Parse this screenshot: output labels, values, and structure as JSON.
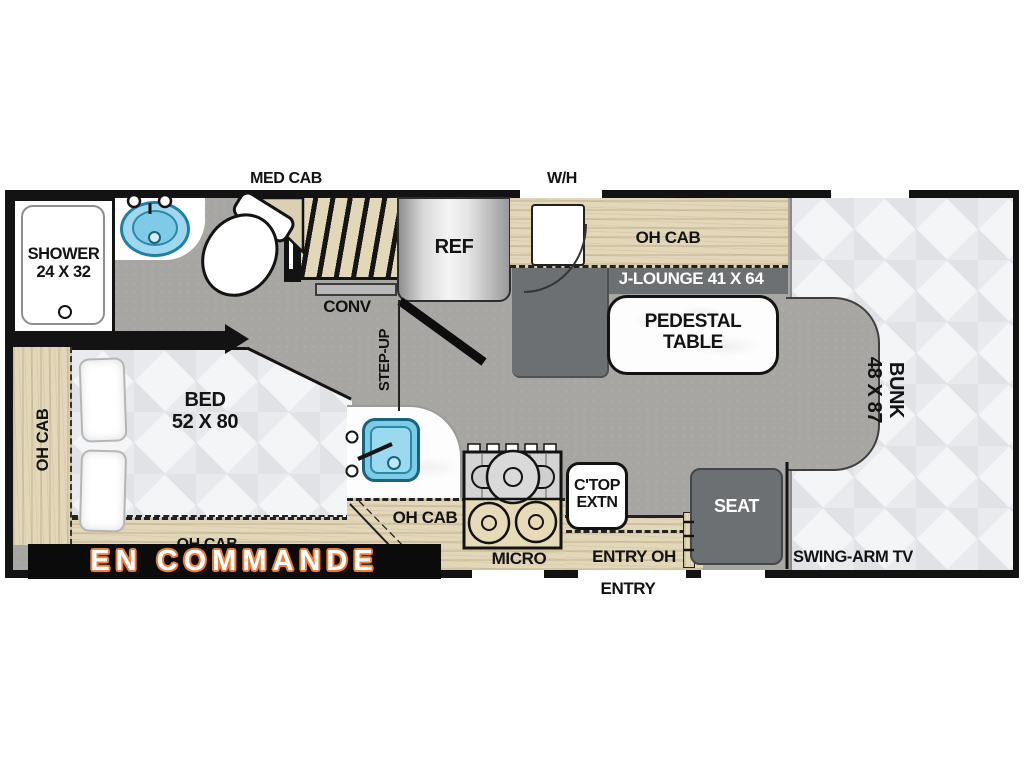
{
  "banner": {
    "text": "EN COMMANDE",
    "bg": "#0b0b0b",
    "text_color": "#ffffff",
    "outline_color": "#e87f3c"
  },
  "exterior": {
    "med_cab": "MED CAB",
    "water_heater": "W/H",
    "entry": "ENTRY"
  },
  "bathroom": {
    "shower_line1": "SHOWER",
    "shower_line2": "24 X 32"
  },
  "galley": {
    "conv": "CONV",
    "ref": "REF",
    "step_up": "STEP-UP",
    "oh_cab": "OH CAB",
    "micro": "MICRO",
    "ctop_line1": "C'TOP",
    "ctop_line2": "EXTN",
    "entry_oh": "ENTRY OH"
  },
  "lounge": {
    "oh_cab": "OH CAB",
    "j_lounge": "J-LOUNGE 41 X 64",
    "pedestal_line1": "PEDESTAL",
    "pedestal_line2": "TABLE",
    "seat": "SEAT"
  },
  "bedroom": {
    "bed_line1": "BED",
    "bed_line2": "52 X 80",
    "oh_cab_left": "OH CAB",
    "oh_cab_bottom": "OH CAB"
  },
  "rear": {
    "bunk_line1": "BUNK",
    "bunk_line2": "48 X 87",
    "swing_arm_tv": "SWING-ARM TV"
  },
  "colors": {
    "floor_gray": "#a8a6a3",
    "wall_black": "#131313",
    "cabinet_wood": "#e3d7ba",
    "seat_gray": "#6d7072",
    "sink_blue": "#7ecbe8",
    "quilt_white": "#f4f5f7",
    "banner_orange": "#e87f3c"
  }
}
